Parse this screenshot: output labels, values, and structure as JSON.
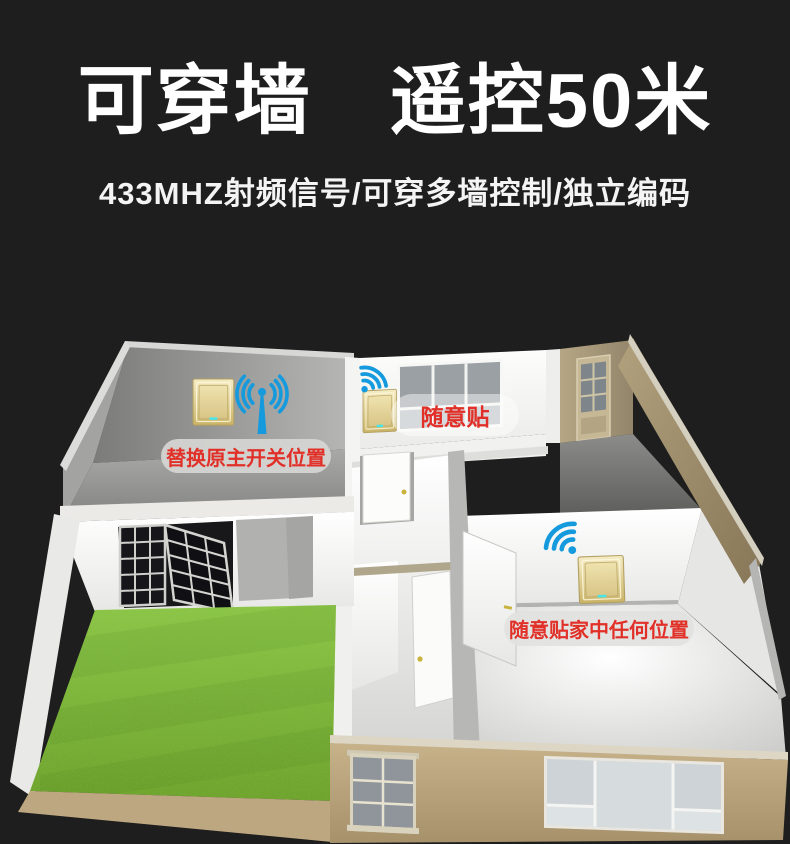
{
  "header": {
    "title": "可穿墙　遥控50米",
    "subtitle": "433MHZ射频信号/可穿多墙控制/独立编码"
  },
  "scene": {
    "description": "3d-house-cutaway-with-wireless-switches",
    "callouts": {
      "replace_main_switch": "替换原主开关位置",
      "stick_freely": "随意贴",
      "stick_anywhere": "随意贴家中任何位置"
    },
    "icons": {
      "antenna": "antenna-signal-icon",
      "wifi": "wifi-signal-icon",
      "switch": "wireless-wall-switch"
    },
    "colors": {
      "background": "#1e1e1e",
      "title_white": "#ffffff",
      "callout_red": "#e13028",
      "signal_blue": "#149add",
      "switch_gold": "#d9c68c",
      "grass_green": "#7cba39",
      "exterior_tan": "#b8a37b",
      "interior_gray": "#a2a2a0"
    }
  }
}
